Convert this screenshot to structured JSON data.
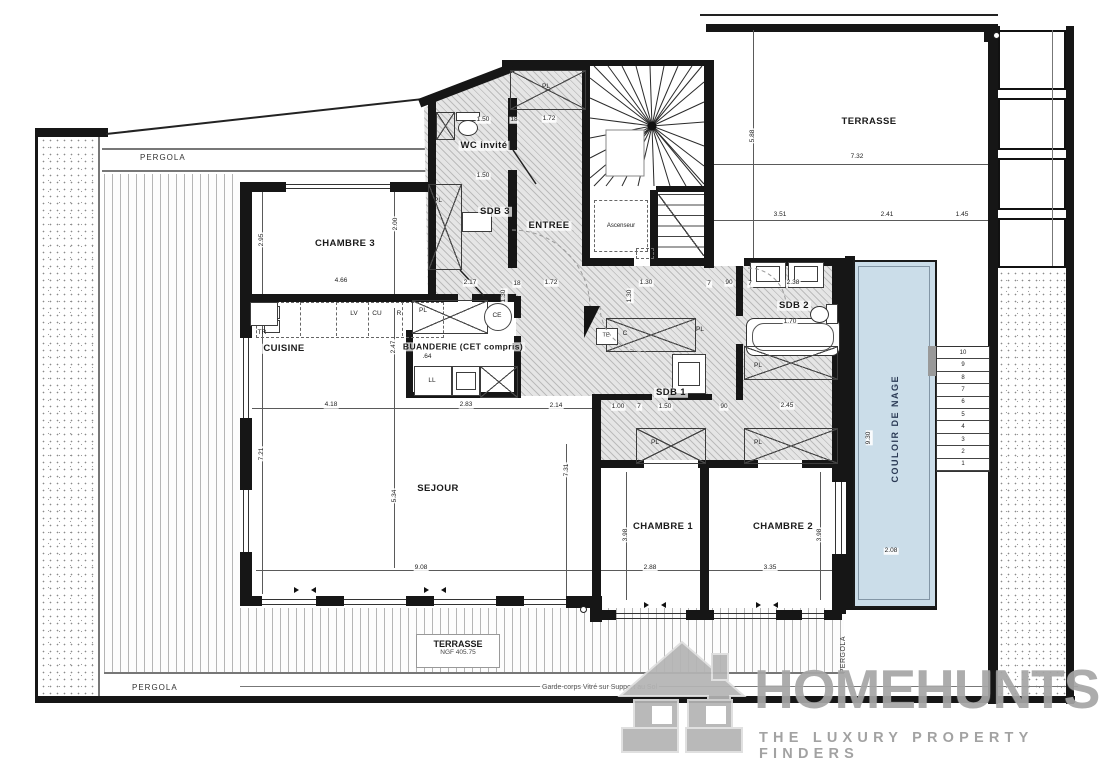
{
  "rooms": {
    "chambre3": "CHAMBRE 3",
    "wc_invite": "WC invité",
    "sdb3": "SDB 3",
    "entree": "ENTREE",
    "cuisine": "CUISINE",
    "buanderie": "BUANDERIE (CET compris)",
    "sdb2": "SDB 2",
    "sdb1": "SDB 1",
    "sejour": "SEJOUR",
    "chambre1": "CHAMBRE 1",
    "chambre2": "CHAMBRE 2"
  },
  "areas": {
    "pergola": "PERGOLA",
    "terrasse_ne": "TERRASSE",
    "terrasse_s": "TERRASSE",
    "ngf": "NGF 405.75",
    "couloir": "COULOIR DE NAGE"
  },
  "labels": {
    "ascenseur": "Ascenseur",
    "garde_corps": "Garde-corps Vitré sur Support au Sol"
  },
  "fixtures": {
    "pl": "PL",
    "lv": "LV",
    "cu": "CU",
    "r": "R",
    "tr": "TR",
    "ce": "CE",
    "ll": "LL",
    "te": "TE",
    "c": "C"
  },
  "dims": [
    "1.50",
    "18",
    "1.72",
    "1.50",
    "2.95",
    "2.00",
    "4.66",
    "2.17",
    "18",
    "1.72",
    "1.30",
    "1.30",
    "1.30",
    "7",
    "90",
    "7",
    "2.38",
    "1.70",
    "2.47",
    ".64",
    "4.18",
    "2.83",
    "2.14",
    "1.00",
    "7",
    "1.50",
    "90",
    "2.45",
    "7.21",
    "5.34",
    "9.08",
    "7.31",
    "3.98",
    "2.88",
    "3.35",
    "3.98",
    "5.88",
    "7.32",
    "3.51",
    "2.41",
    "1.45",
    "9.30",
    "2.08"
  ],
  "stairs": [
    "10",
    "9",
    "8",
    "7",
    "6",
    "5",
    "4",
    "3",
    "2",
    "1"
  ],
  "logo": {
    "brand": "HOMEHUNTS",
    "tagline": "THE LUXURY PROPERTY FINDERS"
  },
  "colors": {
    "wall": "#161616",
    "hatch": "#e5e5e5",
    "pool": "#cbdde9",
    "pool_text": "#2b3a55",
    "logo_gray": "#a6a6a6"
  }
}
